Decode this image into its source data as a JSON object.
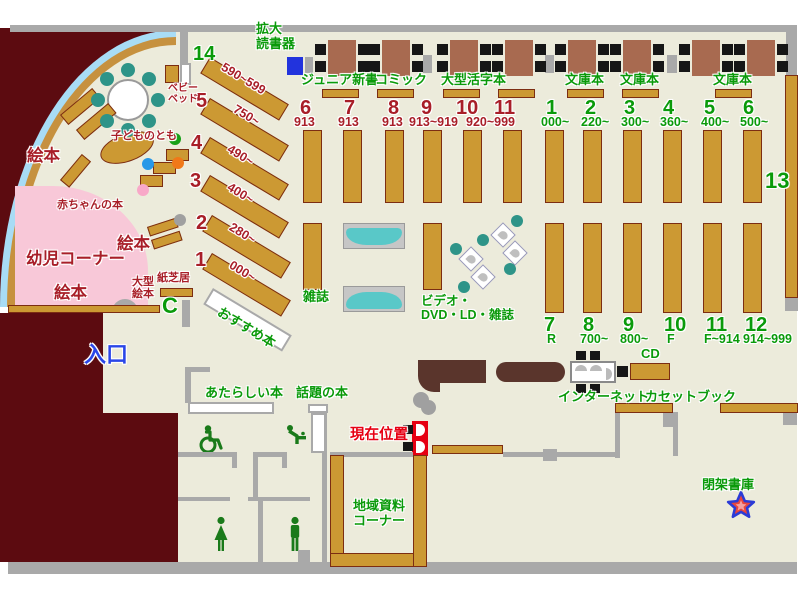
{
  "colors": {
    "floor": "#ECEBDB",
    "outside": "#5C0B10",
    "shelf": "#CC9933",
    "shelf_border": "#7C2D12",
    "green_label": "#0A9A0A",
    "darkred_label": "#A81E28",
    "red_label": "#E60012",
    "blue_label": "#2A46E8",
    "wall_gray": "#A9A9A9",
    "infant_pink": "#F8C8D8",
    "water_blue": "#A8DCF5",
    "bench_teal": "#59C8C8",
    "table_brown": "#A86A50",
    "counter_brown": "#5A352C",
    "device_blue": "#2233DD"
  },
  "labels": [
    {
      "name": "label-kakudai-dokushoki",
      "text": "拡大\n読書器",
      "x": 256,
      "y": 22,
      "cls": "g s13"
    },
    {
      "name": "label-junior-shinsho",
      "text": "ジュニア新書",
      "x": 301,
      "y": 73,
      "cls": "g s13"
    },
    {
      "name": "label-comic",
      "text": "コミック",
      "x": 375,
      "y": 73,
      "cls": "g s13"
    },
    {
      "name": "label-ogata-katsuji-bon",
      "text": "大型活字本",
      "x": 441,
      "y": 73,
      "cls": "g s13"
    },
    {
      "name": "label-bunkobon-1",
      "text": "文庫本",
      "x": 565,
      "y": 73,
      "cls": "g s13"
    },
    {
      "name": "label-bunkobon-2",
      "text": "文庫本",
      "x": 620,
      "y": 73,
      "cls": "g s13"
    },
    {
      "name": "label-bunkobon-3",
      "text": "文庫本",
      "x": 713,
      "y": 73,
      "cls": "g s13"
    },
    {
      "name": "label-zasshi",
      "text": "雑誌",
      "x": 303,
      "y": 290,
      "cls": "g s13"
    },
    {
      "name": "label-video-dvd-ld-zasshi",
      "text": "ビデオ・\nDVD・LD・雑誌",
      "x": 421,
      "y": 294,
      "cls": "g s12"
    },
    {
      "name": "label-osusume-bon",
      "text": "おすすめ本",
      "x": 222,
      "y": 305,
      "cls": "g s13",
      "rot": 31
    },
    {
      "name": "label-atarashii-hon",
      "text": "あたらしい本",
      "x": 205,
      "y": 386,
      "cls": "g s13"
    },
    {
      "name": "label-wadai-no-hon",
      "text": "話題の本",
      "x": 296,
      "y": 386,
      "cls": "g s13"
    },
    {
      "name": "label-internet",
      "text": "インターネット",
      "x": 558,
      "y": 390,
      "cls": "g s13"
    },
    {
      "name": "label-cd",
      "text": "CD",
      "x": 641,
      "y": 347,
      "cls": "g s13"
    },
    {
      "name": "label-cassette-book",
      "text": "カセットブック",
      "x": 645,
      "y": 390,
      "cls": "g s13"
    },
    {
      "name": "label-chiiki-shiryo-corner",
      "text": "地域資料\nコーナー",
      "x": 349,
      "y": 499,
      "cls": "g s13",
      "w": 60
    },
    {
      "name": "label-heika-shoko",
      "text": "閉架書庫",
      "x": 702,
      "y": 478,
      "cls": "g s13"
    },
    {
      "name": "label-num-14",
      "text": "14",
      "x": 193,
      "y": 43,
      "cls": "g s19"
    },
    {
      "name": "label-num-13",
      "text": "13",
      "x": 765,
      "y": 169,
      "cls": "g s21"
    },
    {
      "name": "label-num-1g",
      "text": "1",
      "x": 546,
      "y": 97,
      "cls": "g s19"
    },
    {
      "name": "label-num-2g",
      "text": "2",
      "x": 585,
      "y": 97,
      "cls": "g s19"
    },
    {
      "name": "label-num-3g",
      "text": "3",
      "x": 624,
      "y": 97,
      "cls": "g s19"
    },
    {
      "name": "label-num-4g",
      "text": "4",
      "x": 663,
      "y": 97,
      "cls": "g s19"
    },
    {
      "name": "label-num-5g",
      "text": "5",
      "x": 704,
      "y": 97,
      "cls": "g s19"
    },
    {
      "name": "label-num-6g",
      "text": "6",
      "x": 743,
      "y": 97,
      "cls": "g s19"
    },
    {
      "name": "label-range-000",
      "text": "000~",
      "x": 541,
      "y": 115,
      "cls": "g s12"
    },
    {
      "name": "label-range-220",
      "text": "220~",
      "x": 581,
      "y": 115,
      "cls": "g s12"
    },
    {
      "name": "label-range-300",
      "text": "300~",
      "x": 621,
      "y": 115,
      "cls": "g s12"
    },
    {
      "name": "label-range-360",
      "text": "360~",
      "x": 660,
      "y": 115,
      "cls": "g s12"
    },
    {
      "name": "label-range-400g",
      "text": "400~",
      "x": 701,
      "y": 115,
      "cls": "g s12"
    },
    {
      "name": "label-range-500",
      "text": "500~",
      "x": 740,
      "y": 115,
      "cls": "g s12"
    },
    {
      "name": "label-num-7b",
      "text": "7",
      "x": 544,
      "y": 314,
      "cls": "g s19"
    },
    {
      "name": "label-num-8b",
      "text": "8",
      "x": 583,
      "y": 314,
      "cls": "g s19"
    },
    {
      "name": "label-num-9b",
      "text": "9",
      "x": 623,
      "y": 314,
      "cls": "g s19"
    },
    {
      "name": "label-num-10b",
      "text": "10",
      "x": 664,
      "y": 314,
      "cls": "g s19"
    },
    {
      "name": "label-num-11b",
      "text": "11",
      "x": 706,
      "y": 314,
      "cls": "g s19"
    },
    {
      "name": "label-num-12b",
      "text": "12",
      "x": 745,
      "y": 314,
      "cls": "g s19"
    },
    {
      "name": "label-range-r",
      "text": "R",
      "x": 547,
      "y": 332,
      "cls": "g s12"
    },
    {
      "name": "label-range-700",
      "text": "700~",
      "x": 580,
      "y": 332,
      "cls": "g s12"
    },
    {
      "name": "label-range-800",
      "text": "800~",
      "x": 620,
      "y": 332,
      "cls": "g s12"
    },
    {
      "name": "label-range-f",
      "text": "F",
      "x": 667,
      "y": 332,
      "cls": "g s12"
    },
    {
      "name": "label-range-f914",
      "text": "F~914",
      "x": 704,
      "y": 332,
      "cls": "g s12"
    },
    {
      "name": "label-range-914-999",
      "text": "914~999",
      "x": 743,
      "y": 332,
      "cls": "g s12"
    },
    {
      "name": "label-num-6r",
      "text": "6",
      "x": 300,
      "y": 97,
      "cls": "dr s19"
    },
    {
      "name": "label-num-7r",
      "text": "7",
      "x": 344,
      "y": 97,
      "cls": "dr s19"
    },
    {
      "name": "label-num-8r",
      "text": "8",
      "x": 388,
      "y": 97,
      "cls": "dr s19"
    },
    {
      "name": "label-num-9r",
      "text": "9",
      "x": 421,
      "y": 97,
      "cls": "dr s19"
    },
    {
      "name": "label-num-10r",
      "text": "10",
      "x": 456,
      "y": 97,
      "cls": "dr s19"
    },
    {
      "name": "label-num-11r",
      "text": "11",
      "x": 494,
      "y": 97,
      "cls": "dr s19"
    },
    {
      "name": "label-range-913a",
      "text": "913",
      "x": 294,
      "y": 115,
      "cls": "dr s12"
    },
    {
      "name": "label-range-913b",
      "text": "913",
      "x": 338,
      "y": 115,
      "cls": "dr s12"
    },
    {
      "name": "label-range-913c",
      "text": "913",
      "x": 382,
      "y": 115,
      "cls": "dr s12"
    },
    {
      "name": "label-range-913-919",
      "text": "913~919",
      "x": 409,
      "y": 115,
      "cls": "dr s12"
    },
    {
      "name": "label-range-920-999",
      "text": "920~999",
      "x": 466,
      "y": 115,
      "cls": "dr s12"
    },
    {
      "name": "label-num-5l",
      "text": "5",
      "x": 196,
      "y": 90,
      "cls": "dr s19"
    },
    {
      "name": "label-num-4l",
      "text": "4",
      "x": 191,
      "y": 132,
      "cls": "dr s19"
    },
    {
      "name": "label-num-3l",
      "text": "3",
      "x": 190,
      "y": 170,
      "cls": "dr s19"
    },
    {
      "name": "label-num-2l",
      "text": "2",
      "x": 196,
      "y": 212,
      "cls": "dr s19"
    },
    {
      "name": "label-num-1l",
      "text": "1",
      "x": 195,
      "y": 249,
      "cls": "dr s19"
    },
    {
      "name": "label-range-590-599",
      "text": "590~599",
      "x": 226,
      "y": 60,
      "cls": "dr s12",
      "rot": 31
    },
    {
      "name": "label-range-750",
      "text": "750~",
      "x": 238,
      "y": 102,
      "cls": "dr s12",
      "rot": 31
    },
    {
      "name": "label-range-490",
      "text": "490~",
      "x": 232,
      "y": 142,
      "cls": "dr s12",
      "rot": 31
    },
    {
      "name": "label-range-400l",
      "text": "400~",
      "x": 232,
      "y": 180,
      "cls": "dr s12",
      "rot": 31
    },
    {
      "name": "label-range-280",
      "text": "280~",
      "x": 234,
      "y": 220,
      "cls": "dr s12",
      "rot": 31
    },
    {
      "name": "label-range-000l",
      "text": "000~",
      "x": 234,
      "y": 258,
      "cls": "dr s12",
      "rot": 31
    },
    {
      "name": "label-ehon-1",
      "text": "絵本",
      "x": 27,
      "y": 147,
      "cls": "dr s16"
    },
    {
      "name": "label-ehon-2",
      "text": "絵本",
      "x": 117,
      "y": 235,
      "cls": "dr s16"
    },
    {
      "name": "label-ehon-3",
      "text": "絵本",
      "x": 54,
      "y": 284,
      "cls": "dr s16"
    },
    {
      "name": "label-yoji-corner",
      "text": "幼児コーナー",
      "x": 26,
      "y": 250,
      "cls": "dr s16"
    },
    {
      "name": "label-akachan-no-hon",
      "text": "赤ちゃんの本",
      "x": 57,
      "y": 199,
      "cls": "dr s11"
    },
    {
      "name": "label-kodomo-no-tomo",
      "text": "子どものとも",
      "x": 111,
      "y": 130,
      "cls": "dr s11"
    },
    {
      "name": "label-baby-bed",
      "text": "ベビー\nベッド",
      "x": 168,
      "y": 83,
      "cls": "dr s10"
    },
    {
      "name": "label-ogata-ehon",
      "text": "大型\n絵本",
      "x": 132,
      "y": 276,
      "cls": "dr s11"
    },
    {
      "name": "label-kamishibai",
      "text": "紙芝居",
      "x": 157,
      "y": 272,
      "cls": "dr s11"
    },
    {
      "name": "label-genzai-ichi",
      "text": "現在位置",
      "x": 350,
      "y": 427,
      "cls": "br s14"
    },
    {
      "name": "label-iriguchi",
      "text": "入口",
      "x": 84,
      "y": 343,
      "cls": "bl s21"
    },
    {
      "name": "door-c-symbol",
      "text": "C",
      "x": 162,
      "y": 294,
      "cls": "g s21"
    }
  ],
  "shelves": [
    [
      303,
      130,
      19,
      73
    ],
    [
      343,
      130,
      19,
      73
    ],
    [
      385,
      130,
      19,
      73
    ],
    [
      423,
      130,
      19,
      73
    ],
    [
      463,
      130,
      19,
      73
    ],
    [
      503,
      130,
      19,
      73
    ],
    [
      545,
      130,
      19,
      73
    ],
    [
      583,
      130,
      19,
      73
    ],
    [
      623,
      130,
      19,
      73
    ],
    [
      663,
      130,
      19,
      73
    ],
    [
      703,
      130,
      19,
      73
    ],
    [
      743,
      130,
      19,
      73
    ],
    [
      303,
      223,
      19,
      67
    ],
    [
      423,
      223,
      19,
      67
    ],
    [
      545,
      223,
      19,
      90
    ],
    [
      583,
      223,
      19,
      90
    ],
    [
      623,
      223,
      19,
      90
    ],
    [
      663,
      223,
      19,
      90
    ],
    [
      703,
      223,
      19,
      90
    ],
    [
      743,
      223,
      19,
      90
    ],
    [
      785,
      75,
      13,
      223
    ],
    [
      322,
      89,
      37,
      9
    ],
    [
      377,
      89,
      37,
      9
    ],
    [
      443,
      89,
      37,
      9
    ],
    [
      498,
      89,
      37,
      9
    ],
    [
      567,
      89,
      37,
      9
    ],
    [
      622,
      89,
      37,
      9
    ],
    [
      715,
      89,
      37,
      9
    ],
    [
      630,
      363,
      40,
      17
    ],
    [
      615,
      403,
      58,
      10
    ],
    [
      720,
      403,
      78,
      10
    ],
    [
      432,
      445,
      71,
      9
    ],
    [
      330,
      455,
      14,
      112
    ],
    [
      330,
      553,
      97,
      14
    ],
    [
      413,
      455,
      14,
      112
    ],
    [
      165,
      65,
      14,
      18
    ],
    [
      160,
      288,
      33,
      9
    ],
    [
      8,
      305,
      152,
      8
    ],
    [
      210,
      57,
      92,
      19,
      31
    ],
    [
      210,
      98,
      92,
      19,
      31
    ],
    [
      210,
      137,
      92,
      19,
      31
    ],
    [
      210,
      175,
      92,
      19,
      31
    ],
    [
      212,
      215,
      92,
      19,
      31
    ],
    [
      212,
      253,
      92,
      19,
      31
    ],
    [
      60,
      115,
      42,
      13,
      -40
    ],
    [
      76,
      130,
      42,
      13,
      -40
    ],
    [
      60,
      180,
      34,
      12,
      -50
    ],
    [
      166,
      149,
      23,
      12
    ],
    [
      153,
      162,
      23,
      12
    ],
    [
      140,
      175,
      23,
      12
    ],
    [
      147,
      227,
      30,
      10,
      -18
    ],
    [
      151,
      240,
      30,
      10,
      -18
    ],
    [
      96,
      144,
      56,
      28,
      -20,
      1
    ]
  ],
  "white_shelves": [
    [
      188,
      402,
      86,
      12
    ],
    [
      308,
      404,
      20,
      9
    ],
    [
      311,
      413,
      15,
      40
    ],
    [
      213,
      288,
      92,
      19,
      31
    ],
    [
      180,
      63,
      11,
      22
    ]
  ],
  "walls": [
    [
      10,
      25,
      787,
      7
    ],
    [
      786,
      27,
      11,
      48
    ],
    [
      8,
      562,
      789,
      12
    ],
    [
      180,
      28,
      8,
      45
    ],
    [
      305,
      57,
      8,
      16
    ],
    [
      423,
      55,
      9,
      18
    ],
    [
      545,
      55,
      9,
      18
    ],
    [
      667,
      55,
      10,
      18
    ],
    [
      785,
      298,
      13,
      13
    ],
    [
      182,
      300,
      8,
      27
    ],
    [
      185,
      367,
      6,
      36
    ],
    [
      185,
      367,
      25,
      5
    ],
    [
      330,
      452,
      83,
      5
    ],
    [
      503,
      452,
      114,
      5
    ],
    [
      543,
      449,
      14,
      12
    ],
    [
      178,
      452,
      57,
      5
    ],
    [
      253,
      452,
      34,
      5
    ],
    [
      232,
      452,
      5,
      16
    ],
    [
      282,
      452,
      5,
      16
    ],
    [
      253,
      452,
      5,
      45
    ],
    [
      178,
      497,
      52,
      4
    ],
    [
      248,
      497,
      62,
      4
    ],
    [
      258,
      500,
      5,
      62
    ],
    [
      322,
      413,
      5,
      149
    ],
    [
      298,
      550,
      12,
      14
    ],
    [
      615,
      412,
      5,
      46
    ],
    [
      673,
      412,
      5,
      44
    ],
    [
      663,
      412,
      15,
      15
    ],
    [
      783,
      412,
      14,
      13
    ]
  ],
  "tables": {
    "xs": [
      328,
      382,
      450,
      505,
      568,
      623,
      692,
      747
    ],
    "y": 40
  },
  "round_table": {
    "cx": 128,
    "cy": 100,
    "r": 21,
    "seats": 8,
    "seat_r": 7,
    "seat_dist": 30
  },
  "carrels": [
    [
      494,
      226
    ],
    [
      506,
      244
    ],
    [
      462,
      250
    ],
    [
      474,
      268
    ]
  ],
  "benches": [
    [
      343,
      223
    ],
    [
      343,
      286
    ]
  ],
  "dots": [
    [
      175,
      139,
      6,
      "#18A018"
    ],
    [
      178,
      163,
      6,
      "#F07818"
    ],
    [
      148,
      164,
      6,
      "#2898E8"
    ],
    [
      143,
      190,
      6,
      "#F8A8C8"
    ],
    [
      180,
      220,
      6,
      "#A0A0A0"
    ],
    [
      421,
      400,
      8,
      "#A0A0A0"
    ],
    [
      517,
      221,
      6,
      "#2E9488"
    ],
    [
      483,
      240,
      6,
      "#2E9488"
    ],
    [
      456,
      249,
      6,
      "#2E9488"
    ],
    [
      510,
      269,
      6,
      "#2E9488"
    ],
    [
      464,
      287,
      6,
      "#2E9488"
    ]
  ]
}
